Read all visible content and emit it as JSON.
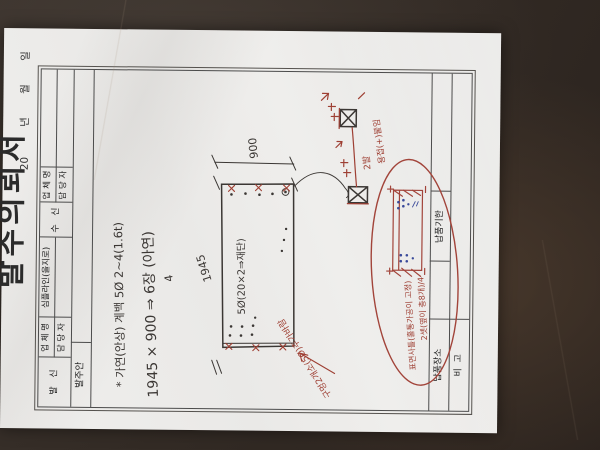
{
  "form": {
    "title": "발주의뢰서",
    "date_line": "20         년       월       일",
    "sender_label": "발   신",
    "receiver_label": "수   신",
    "company_label": "업 체 명",
    "manager_label": "담 당 자",
    "sender_company": "심플라인(을지로)",
    "order_section_label": "발주안",
    "delivery_place_label": "납품장소",
    "delivery_deadline_label": "납품기한",
    "remarks_label": "비  고"
  },
  "handwriting": {
    "note_material": "* 가연(안상) 계백  5Ø 2~4(1.6t)",
    "note_size": "1945 × 900 ⇒ 6장 (아연)",
    "note_qty": "4",
    "dim_length": "1945",
    "dim_width": "900",
    "panel_note": "5Ø(20×2⇒재단)",
    "red_hole_note": "구멍2개소(5Ø)추가바람",
    "red_weld_count": "2발",
    "red_weld_note": "용접(+)붙임",
    "red_detail_note1": "표면사틀(홀통가공이 고정)",
    "red_detail_note2": "2셋(옆이 총8개)/4"
  },
  "colors": {
    "background": "#332b25",
    "paper": "#edecea",
    "table_line": "#4c4c4c",
    "black_ink": "#3b3734",
    "red_ink": "#9e3f33",
    "blue_ink": "#3a4a9a"
  }
}
